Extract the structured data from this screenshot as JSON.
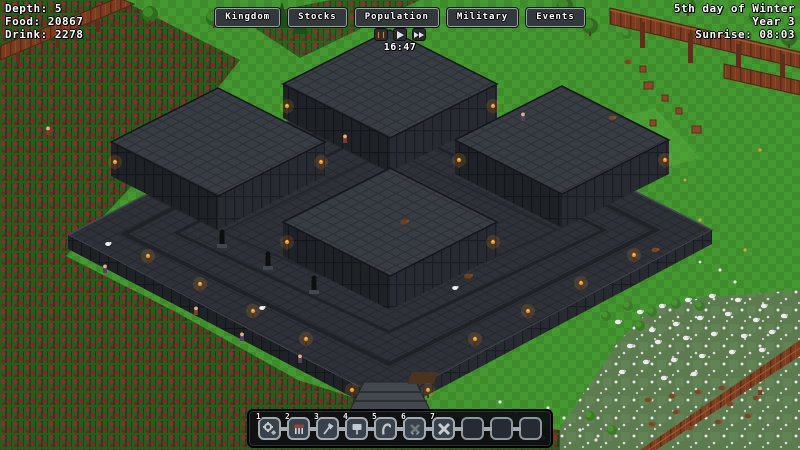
{
  "hud": {
    "depth": "Depth: 5",
    "food": "Food: 20867",
    "drink": "Drink: 2278"
  },
  "menu": {
    "kingdom": "Kingdom",
    "stocks": "Stocks",
    "population": "Population",
    "military": "Military",
    "events": "Events"
  },
  "time": {
    "clock": "16:47",
    "controls": {
      "pause": "pause-icon",
      "play": "play-icon",
      "fast_forward": "fast-forward-icon"
    }
  },
  "calendar": {
    "date": "5th day of Winter",
    "year": "Year 3",
    "sunrise": "Sunrise: 08:03"
  },
  "toolbar": {
    "slots": [
      {
        "number": "1",
        "icon": "gear-gem-icon"
      },
      {
        "number": "2",
        "icon": "farm-icon"
      },
      {
        "number": "3",
        "icon": "axe-icon"
      },
      {
        "number": "4",
        "icon": "sign-post-icon"
      },
      {
        "number": "5",
        "icon": "hook-icon"
      },
      {
        "number": "6",
        "icon": "crossed-swords-dark-icon"
      },
      {
        "number": "7",
        "icon": "crossed-swords-icon"
      },
      {
        "number": "",
        "icon": ""
      },
      {
        "number": "",
        "icon": ""
      },
      {
        "number": "",
        "icon": ""
      }
    ]
  },
  "scene": {
    "description": "Isometric dark stone fortress with four raised square towers, surrounded by red-berry crop fields, wooden walkways, and a livestock pasture with sheep and boars",
    "palette": {
      "grass": "#3e8c2c",
      "grass_light": "#449a31",
      "berry_red": "#a02038",
      "stone_top": "#30343a",
      "stone_wall": "#1e2126",
      "wood": "#7c3c20",
      "torch_flame": "#e08a2b",
      "sheep_white": "#ececec"
    }
  }
}
